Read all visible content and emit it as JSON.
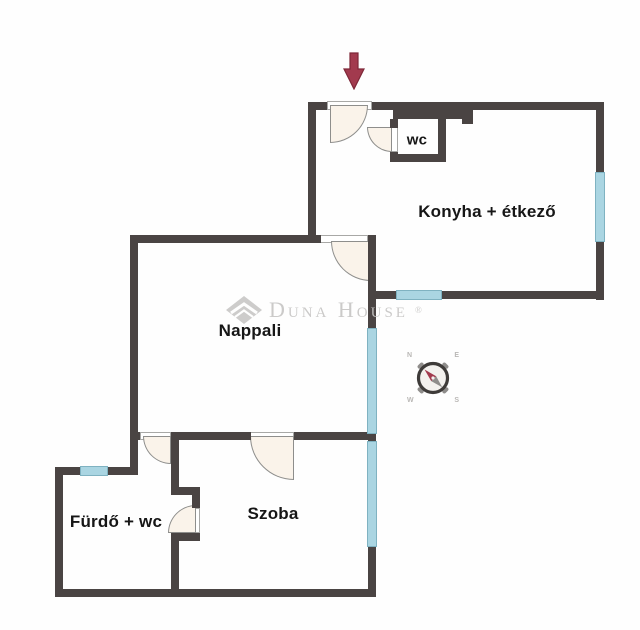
{
  "rooms": {
    "kitchen": "Konyha + étkező",
    "wc": "wc",
    "living": "Nappali",
    "bedroom": "Szoba",
    "bathroom": "Fürdő + wc"
  },
  "watermark": {
    "brand": "Duna House",
    "registered": "®"
  },
  "compass": {
    "n": "N",
    "e": "E",
    "s": "S",
    "w": "W"
  },
  "colors": {
    "wall": "#4a4443",
    "window_fill": "#aad5e2",
    "window_border": "#7fb2c1",
    "door_fill": "#faf3ea",
    "door_border": "#8e8e8c",
    "entrance_arrow": "#a23a4e",
    "entrance_arrow_outline": "#7e2738",
    "label_text": "#161616",
    "watermark": "#c7c6c5"
  }
}
